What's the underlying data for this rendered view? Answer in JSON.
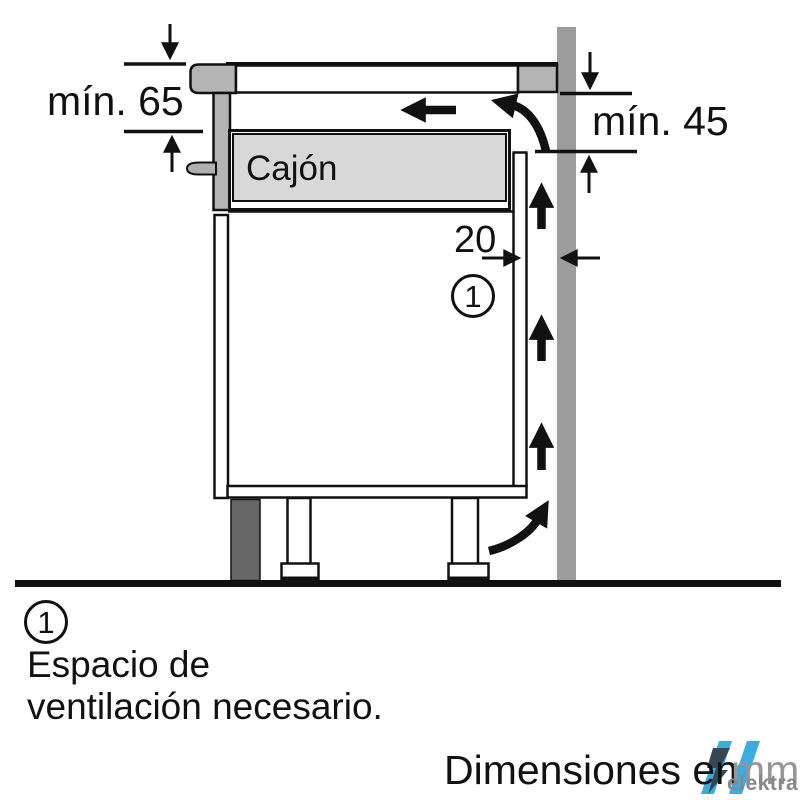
{
  "diagram": {
    "title_context": "Installation clearance diagram",
    "dimensions": {
      "top_left_min": "mín. 65",
      "top_right_min": "mín. 45",
      "rear_gap": "20"
    },
    "labels": {
      "drawer": "Cajón"
    },
    "callouts": {
      "top": "1",
      "legend": "1"
    },
    "legend": {
      "line1": "Espacio de",
      "line2": "ventilación necesario."
    },
    "footer": {
      "units_prefix": "Dimensiones en",
      "units_unit": "mm",
      "watermark": "elektra"
    },
    "colors": {
      "line": "#111111",
      "wall_gray": "#9c9c9c",
      "worktop_gray": "#b4b4b4",
      "handle_gray": "#b0b0b0",
      "drawer_gray": "#d8d8d8",
      "plinth_gray": "#676767",
      "watermark_cyan": "#2fa9de",
      "watermark_dark": "#2c3e4a",
      "watermark_text_gray": "#85898c",
      "units_mm_gray": "#969696"
    }
  }
}
